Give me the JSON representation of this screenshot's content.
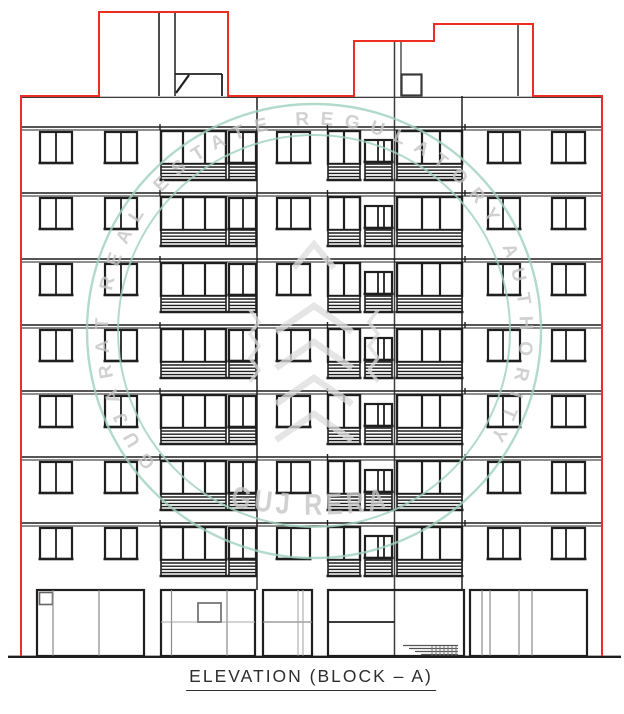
{
  "caption": {
    "label": "ELEVATION (BLOCK – A)"
  },
  "watermark": {
    "ring_text": "GUJARAT REAL ESTATE REGULATORY AUTHORITY",
    "center_text": "GUJ RERA"
  },
  "drawing": {
    "floors": 7,
    "colors": {
      "outline": "#ee2e22",
      "line": "#1f1f1f",
      "mid": "#3c3c3c",
      "detail": "#8a8a8a",
      "light_detail": "#a8a8a8",
      "wall": "#ffffff",
      "watermark_ring": "#9fd2bd",
      "watermark_text": "#c6c6c6",
      "watermark_emblem": "#dedede"
    }
  }
}
